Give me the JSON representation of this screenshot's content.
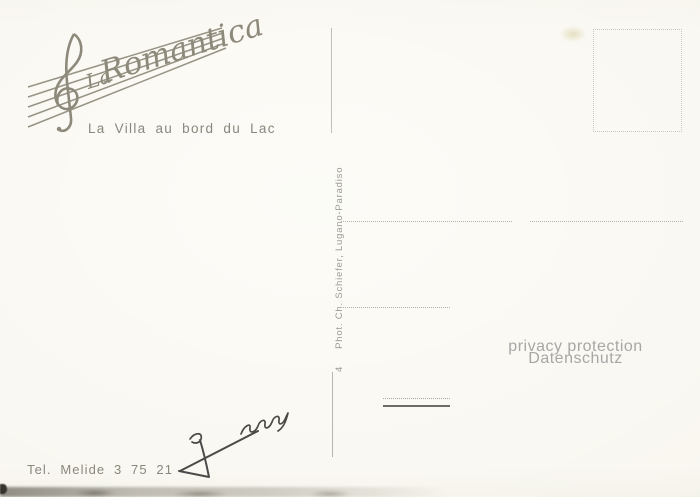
{
  "card": {
    "logo": {
      "brand_prefix": "La",
      "brand_name": "Romantica",
      "subtitle": "La Villa au bord du Lac"
    },
    "divider": {
      "number": "4",
      "credit": "Phot. Ch. Schiefer, Lugano-Paradiso"
    },
    "privacy": {
      "line1": "privacy protection",
      "line2": "Datenschutz"
    },
    "footer": {
      "phone": "Tel. Melide 3 75 21"
    },
    "icons": {
      "treble_clef": "musical G-clef drawn over slanted staff lines",
      "staff_lines": "five converging diagonal staff lines",
      "stamp_box": "dotted rectangle stamp placeholder",
      "signature": "handwritten dark-ink signature"
    },
    "colors": {
      "ink": "#8d8a7b",
      "ink_soft": "#8a887c",
      "paper": "#f7f5ee",
      "privacy_gray": "#a7a7a7",
      "line_gray": "#b5b3a9",
      "dot_gray": "#c9c7bc",
      "credit_gray": "#9b9992",
      "signature_ink": "#4a4a48"
    }
  }
}
